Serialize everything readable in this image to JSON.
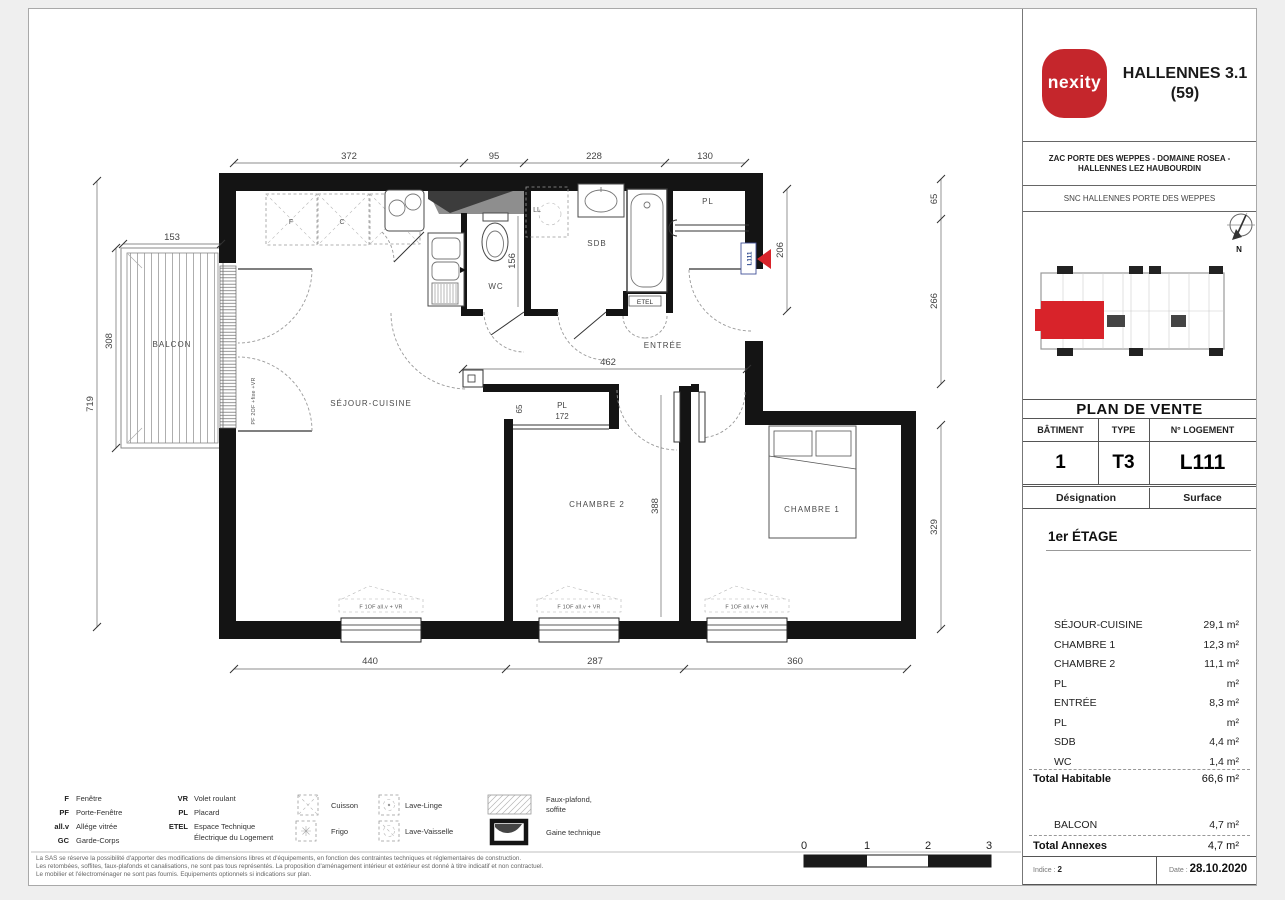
{
  "header": {
    "brand": "nexity",
    "project_line1": "HALLENNES 3.1",
    "project_line2": "(59)",
    "zac_line1": "ZAC PORTE DES WEPPES - DOMAINE ROSEA -",
    "zac_line2": "HALLENNES LEZ HAUBOURDIN",
    "snc": "SNC HALLENNES PORTE DES WEPPES",
    "north": "N"
  },
  "sale": {
    "title": "PLAN DE VENTE",
    "col_batiment": "BÂTIMENT",
    "col_type": "TYPE",
    "col_logement": "N° LOGEMENT",
    "batiment": "1",
    "type": "T3",
    "logement": "L111",
    "designation": "Désignation",
    "surface": "Surface",
    "floor": "1er ÉTAGE"
  },
  "surfaces": {
    "rows": [
      {
        "label": "SÉJOUR-CUISINE",
        "value": "29,1 m²"
      },
      {
        "label": "CHAMBRE 1",
        "value": "12,3 m²"
      },
      {
        "label": "CHAMBRE 2",
        "value": "11,1 m²"
      },
      {
        "label": "PL",
        "value": "m²"
      },
      {
        "label": "ENTRÉE",
        "value": "8,3 m²"
      },
      {
        "label": "PL",
        "value": "m²"
      },
      {
        "label": "SDB",
        "value": "4,4 m²"
      },
      {
        "label": "WC",
        "value": "1,4 m²"
      }
    ],
    "total_habitable_label": "Total Habitable",
    "total_habitable_value": "66,6 m²",
    "balcon_label": "BALCON",
    "balcon_value": "4,7 m²",
    "total_annexes_label": "Total Annexes",
    "total_annexes_value": "4,7 m²"
  },
  "footer": {
    "indice_label": "Indice :",
    "indice_value": "2",
    "date_label": "Date :",
    "date_value": "28.10.2020"
  },
  "plan": {
    "rooms": {
      "sejour": "SÉJOUR-CUISINE",
      "chambre2": "CHAMBRE 2",
      "chambre1": "CHAMBRE 1",
      "entree": "ENTRÉE",
      "wc": "WC",
      "sdb": "SDB",
      "pl": "PL",
      "balcon": "BALCON",
      "etel": "ETEL"
    },
    "appliances": {
      "f": "F",
      "c": "C",
      "lv": "LV",
      "ll": "LL"
    },
    "dims": {
      "top_1": "372",
      "top_2": "95",
      "top_3": "228",
      "top_4": "130",
      "bottom_1": "440",
      "bottom_2": "287",
      "bottom_3": "360",
      "left_1": "153",
      "left_2": "308",
      "left_3": "719",
      "right_1": "65",
      "right_2": "266",
      "right_3": "329",
      "entree_w": "462",
      "entree_h": "206",
      "wc_h": "156",
      "ch2_h": "388",
      "pl_label": "PL",
      "pl_w": "172",
      "pl_d": "65"
    },
    "tags": {
      "unit": "L111",
      "balcony_door": "PF 2OF +fixe +VR",
      "window": "F 1OF all.v + VR"
    }
  },
  "legend": {
    "col1": [
      {
        "k": "F",
        "v": "Fenêtre"
      },
      {
        "k": "PF",
        "v": "Porte-Fenêtre"
      },
      {
        "k": "all.v",
        "v": "Allége vitrée"
      },
      {
        "k": "GC",
        "v": "Garde-Corps"
      }
    ],
    "col2": [
      {
        "k": "VR",
        "v": "Volet roulant"
      },
      {
        "k": "PL",
        "v": "Placard"
      },
      {
        "k": "ETEL",
        "v": "Espace Technique"
      },
      {
        "k": "",
        "v": "Électrique du Logement"
      }
    ],
    "sym": {
      "cuisson": "Cuisson",
      "frigo": "Frigo",
      "lavelinge": "Lave-Linge",
      "lavevaisselle": "Lave-Vaisselle",
      "fauxplafond1": "Faux-plafond,",
      "fauxplafond2": "soffite",
      "gaine": "Gaine technique"
    }
  },
  "scalebar": {
    "t0": "0",
    "t1": "1",
    "t2": "2",
    "t3": "3"
  },
  "disclaimer": {
    "l1": "La SAS se réserve la possibilité d'apporter des modifications de dimensions libres et d'équipements, en fonction des contraintes techniques et réglementaires de construction.",
    "l2": "Les retombées, soffites, faux-plafonds et canalisations, ne sont pas tous représentés. La proposition d'aménagement intérieur et extérieur est donné à titre indicatif et non contractuel.",
    "l3": "Le mobilier et l'électroménager ne sont pas fournis. Equipements optionnels si indications sur plan."
  }
}
